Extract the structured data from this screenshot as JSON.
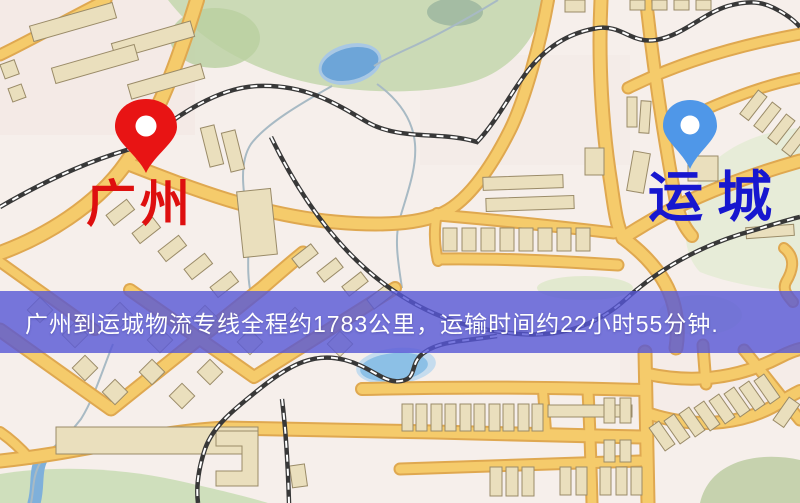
{
  "markers": {
    "origin": {
      "label": "广州",
      "pin_color": "#e81414",
      "label_color": "#de0f0f"
    },
    "destination": {
      "label": "运城",
      "pin_color": "#4f97e8",
      "label_color": "#1717cf"
    }
  },
  "banner": {
    "text": "广州到运城物流专线全程约1783公里，运输时间约22小时55分钟.",
    "background_color": "#5656d6",
    "text_color": "#ffffff",
    "route": {
      "origin": "广州",
      "destination": "运城",
      "distance_text": "约1783公里",
      "duration_text": "约22小时55分钟"
    }
  },
  "map": {
    "type": "street-map",
    "road_color": "#f5cb6b",
    "road_casing_color": "#dfa850",
    "water_color": "#6da5d8",
    "park_color": "#cbdab6",
    "railway_style": "black-white-dashed"
  }
}
